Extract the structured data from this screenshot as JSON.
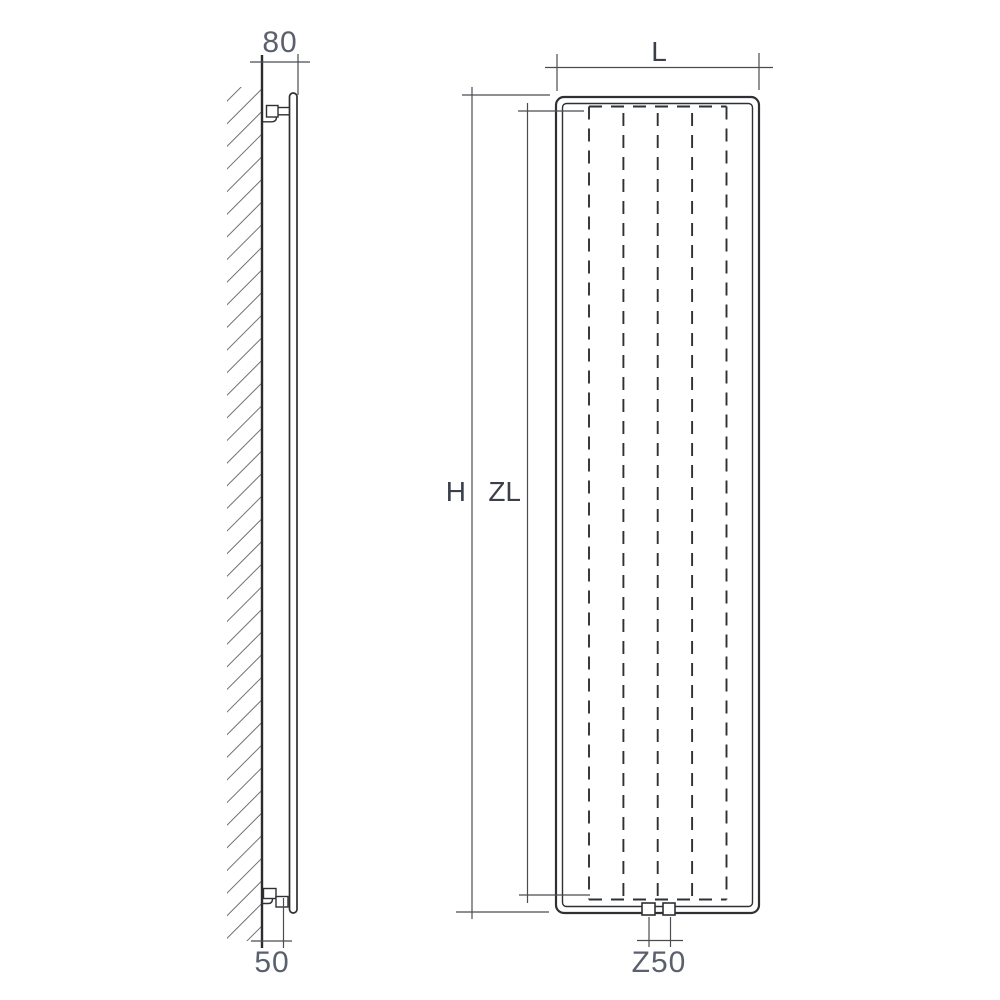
{
  "drawing": {
    "type": "technical-dimension-drawing",
    "subject": "vertical panel radiator - side elevation and front elevation",
    "colors": {
      "background": "#ffffff",
      "object_line": "#2f3033",
      "dimension_line": "#4b4c50",
      "hatch_line": "#707176",
      "number_label": "#5a616d",
      "letter_label": "#3a3f49"
    },
    "side_view": {
      "depth_dim": "80",
      "wall_offset_dim": "50"
    },
    "front_view": {
      "width_dim": "L",
      "height_dim": "H",
      "inner_height_dim": "ZL",
      "connection_spacing_dim": "Z50"
    }
  }
}
